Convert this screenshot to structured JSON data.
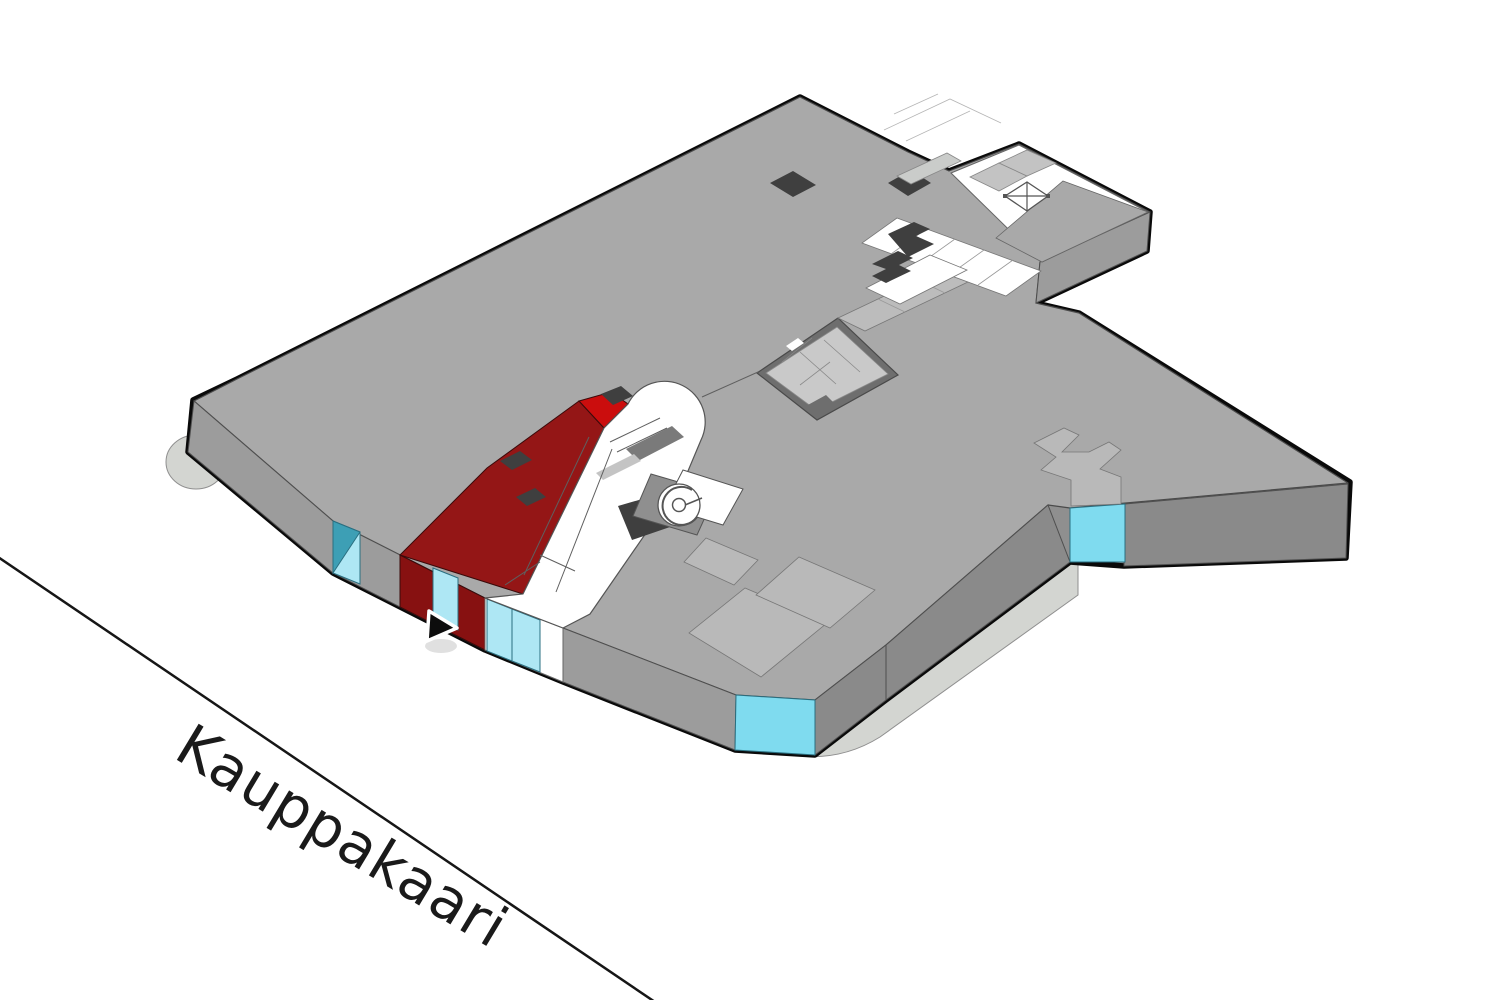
{
  "street": {
    "label": "Kauppakaari"
  },
  "map": {
    "description": "isometric shopping-centre floor plan slab",
    "highlighted_store": "dark-red unit on south-west facade",
    "entrance_marker": "black triangle arrow pointing at highlighted store entrance",
    "icons": {
      "elevator": "isometric box with X",
      "spiral_staircase": "concentric spiral disc",
      "escalator": "banded ramp in rounded white atrium"
    }
  },
  "colors": {
    "background": "#ffffff",
    "outline": "#0a0a0a",
    "slab_top": "#a9a9a9",
    "slab_side": "#8f8f8f",
    "slab_side_light": "#9c9c9c",
    "slab_side_dark": "#8a8a8a",
    "apron": "#d3d5d1",
    "apron_stroke": "#8f8f8f",
    "line_thin": "#5f5f5f",
    "tile_light": "#bcbcbc",
    "tile_lighter": "#c9c9c9",
    "wall": "#6e6e6e",
    "door_dark": "#3f3f3f",
    "store_red": "#941616",
    "store_red_bright": "#cb0d0d",
    "store_red_front": "#871111",
    "glass": "#aee7f4",
    "glass_mid": "#7fdbef",
    "glass_dark": "#3d9fb5",
    "escalator_band": "#7a7a7a",
    "label": "#1a1a1a",
    "street": "#161616"
  }
}
